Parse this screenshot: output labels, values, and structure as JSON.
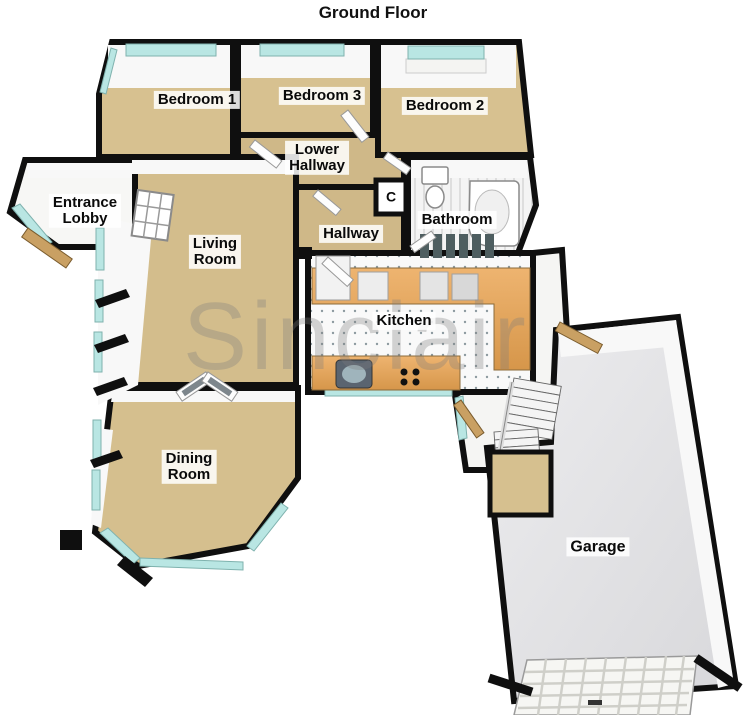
{
  "title": "Ground Floor",
  "watermark": "Sinclair",
  "colors": {
    "wall": "#0f0f0f",
    "carpet": "#d5bf8e",
    "window_glass": "#b9e6e3",
    "kitchen_counter": "#e2a55d",
    "garage_floor": "#e4e4e6",
    "wood_door": "#c9a063"
  },
  "rooms": [
    {
      "id": "bedroom-1",
      "label": "Bedroom 1"
    },
    {
      "id": "bedroom-3",
      "label": "Bedroom 3"
    },
    {
      "id": "bedroom-2",
      "label": "Bedroom 2"
    },
    {
      "id": "lower-hallway",
      "label": "Lower\nHallway"
    },
    {
      "id": "entrance-lobby",
      "label": "Entrance\nLobby"
    },
    {
      "id": "living-room",
      "label": "Living\nRoom"
    },
    {
      "id": "hallway",
      "label": "Hallway"
    },
    {
      "id": "cupboard",
      "label": "C"
    },
    {
      "id": "bathroom",
      "label": "Bathroom"
    },
    {
      "id": "kitchen",
      "label": "Kitchen"
    },
    {
      "id": "dining-room",
      "label": "Dining\nRoom"
    },
    {
      "id": "garage",
      "label": "Garage"
    }
  ]
}
